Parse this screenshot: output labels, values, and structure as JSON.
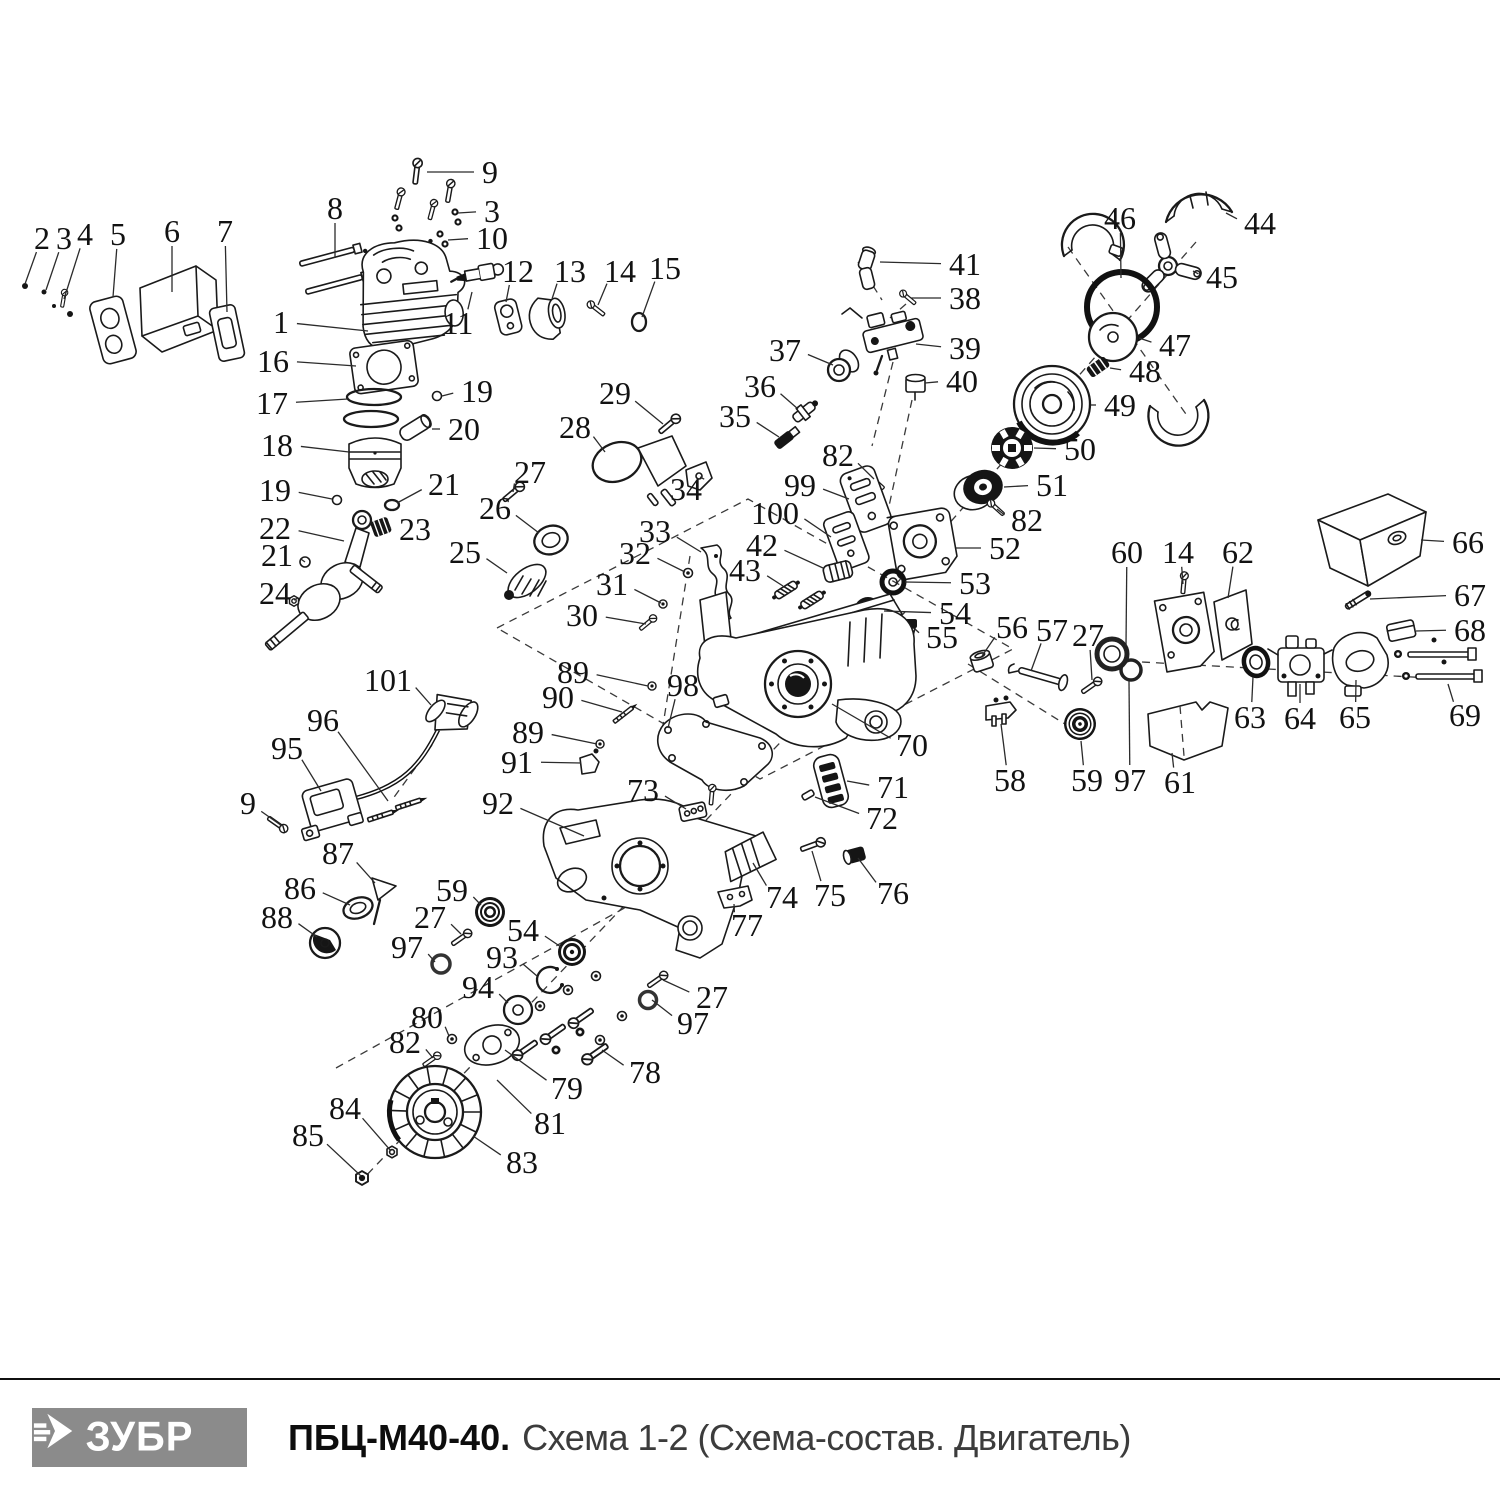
{
  "footer": {
    "logo_text": "ЗУБР",
    "logo_icon": "zubr-arrow-icon",
    "title_bold": "ПБЦ-М40-40.",
    "title_rest": "Схема 1-2 (Схема-состав. Двигатель)"
  },
  "diagram": {
    "labels": [
      {
        "t": "2",
        "x": 42,
        "y": 238,
        "tx": 25,
        "ty": 284
      },
      {
        "t": "3",
        "x": 64,
        "y": 238,
        "tx": 46,
        "ty": 290
      },
      {
        "t": "4",
        "x": 85,
        "y": 234,
        "tx": 64,
        "ty": 299
      },
      {
        "t": "5",
        "x": 118,
        "y": 234,
        "tx": 113,
        "ty": 297
      },
      {
        "t": "6",
        "x": 172,
        "y": 231,
        "tx": 172,
        "ty": 292
      },
      {
        "t": "7",
        "x": 225,
        "y": 231,
        "tx": 227,
        "ty": 312
      },
      {
        "t": "9",
        "x": 490,
        "y": 172,
        "tx": 427,
        "ty": 172
      },
      {
        "t": "8",
        "x": 335,
        "y": 208,
        "tx": 335,
        "ty": 258
      },
      {
        "t": "3",
        "x": 492,
        "y": 211,
        "tx": 458,
        "ty": 213
      },
      {
        "t": "10",
        "x": 492,
        "y": 238,
        "tx": 448,
        "ty": 240
      },
      {
        "t": "1",
        "x": 281,
        "y": 322,
        "tx": 368,
        "ty": 331
      },
      {
        "t": "11",
        "x": 458,
        "y": 323,
        "tx": 472,
        "ty": 292
      },
      {
        "t": "12",
        "x": 518,
        "y": 271,
        "tx": 506,
        "ty": 302
      },
      {
        "t": "13",
        "x": 570,
        "y": 271,
        "tx": 552,
        "ty": 299
      },
      {
        "t": "14",
        "x": 620,
        "y": 271,
        "tx": 598,
        "ty": 305
      },
      {
        "t": "15",
        "x": 665,
        "y": 268,
        "tx": 642,
        "ty": 317
      },
      {
        "t": "16",
        "x": 273,
        "y": 361,
        "tx": 356,
        "ty": 366
      },
      {
        "t": "17",
        "x": 272,
        "y": 403,
        "tx": 348,
        "ty": 399
      },
      {
        "t": "19",
        "x": 477,
        "y": 391,
        "tx": 442,
        "ty": 396
      },
      {
        "t": "20",
        "x": 464,
        "y": 429,
        "tx": 432,
        "ty": 429
      },
      {
        "t": "18",
        "x": 277,
        "y": 445,
        "tx": 349,
        "ty": 452
      },
      {
        "t": "19",
        "x": 275,
        "y": 490,
        "tx": 332,
        "ty": 499
      },
      {
        "t": "21",
        "x": 444,
        "y": 484,
        "tx": 397,
        "ty": 503
      },
      {
        "t": "22",
        "x": 275,
        "y": 528,
        "tx": 344,
        "ty": 541
      },
      {
        "t": "23",
        "x": 415,
        "y": 529,
        "tx": 389,
        "ty": 528
      },
      {
        "t": "21",
        "x": 277,
        "y": 555,
        "tx": 305,
        "ty": 562
      },
      {
        "t": "24",
        "x": 275,
        "y": 593,
        "tx": 294,
        "ty": 600
      },
      {
        "t": "25",
        "x": 465,
        "y": 552,
        "tx": 507,
        "ty": 573
      },
      {
        "t": "26",
        "x": 495,
        "y": 508,
        "tx": 539,
        "ty": 533
      },
      {
        "t": "27",
        "x": 530,
        "y": 472,
        "tx": 513,
        "ty": 492
      },
      {
        "t": "28",
        "x": 575,
        "y": 427,
        "tx": 605,
        "ty": 452
      },
      {
        "t": "29",
        "x": 615,
        "y": 393,
        "tx": 663,
        "ty": 424
      },
      {
        "t": "34",
        "x": 686,
        "y": 489,
        "tx": 700,
        "ty": 477
      },
      {
        "t": "33",
        "x": 655,
        "y": 531,
        "tx": 701,
        "ty": 552
      },
      {
        "t": "32",
        "x": 635,
        "y": 553,
        "tx": 685,
        "ty": 572
      },
      {
        "t": "31",
        "x": 612,
        "y": 584,
        "tx": 661,
        "ty": 603
      },
      {
        "t": "30",
        "x": 582,
        "y": 615,
        "tx": 646,
        "ty": 624
      },
      {
        "t": "35",
        "x": 735,
        "y": 416,
        "tx": 779,
        "ty": 437
      },
      {
        "t": "36",
        "x": 760,
        "y": 386,
        "tx": 798,
        "ty": 409
      },
      {
        "t": "37",
        "x": 785,
        "y": 350,
        "tx": 833,
        "ty": 365
      },
      {
        "t": "41",
        "x": 965,
        "y": 264,
        "tx": 880,
        "ty": 262
      },
      {
        "t": "38",
        "x": 965,
        "y": 298,
        "tx": 911,
        "ty": 298
      },
      {
        "t": "39",
        "x": 965,
        "y": 348,
        "tx": 916,
        "ty": 344
      },
      {
        "t": "40",
        "x": 962,
        "y": 381,
        "tx": 925,
        "ty": 383
      },
      {
        "t": "46",
        "x": 1120,
        "y": 218,
        "tx": 1121,
        "ty": 278
      },
      {
        "t": "44",
        "x": 1260,
        "y": 223,
        "tx": 1226,
        "ty": 213
      },
      {
        "t": "45",
        "x": 1222,
        "y": 277,
        "tx": 1193,
        "ty": 271
      },
      {
        "t": "47",
        "x": 1175,
        "y": 345,
        "tx": 1139,
        "ty": 338
      },
      {
        "t": "48",
        "x": 1145,
        "y": 371,
        "tx": 1110,
        "ty": 368
      },
      {
        "t": "49",
        "x": 1120,
        "y": 405,
        "tx": 1091,
        "ty": 405
      },
      {
        "t": "50",
        "x": 1080,
        "y": 449,
        "tx": 1034,
        "ty": 448
      },
      {
        "t": "51",
        "x": 1052,
        "y": 485,
        "tx": 1004,
        "ty": 487
      },
      {
        "t": "82",
        "x": 1027,
        "y": 520,
        "tx": 997,
        "ty": 509
      },
      {
        "t": "52",
        "x": 1005,
        "y": 548,
        "tx": 956,
        "ty": 548
      },
      {
        "t": "53",
        "x": 975,
        "y": 583,
        "tx": 905,
        "ty": 582
      },
      {
        "t": "54",
        "x": 955,
        "y": 613,
        "tx": 884,
        "ty": 611
      },
      {
        "t": "55",
        "x": 942,
        "y": 637,
        "tx": 915,
        "ty": 629
      },
      {
        "t": "82",
        "x": 838,
        "y": 455,
        "tx": 874,
        "ty": 479
      },
      {
        "t": "99",
        "x": 800,
        "y": 485,
        "tx": 849,
        "ty": 499
      },
      {
        "t": "100",
        "x": 775,
        "y": 513,
        "tx": 831,
        "ty": 537
      },
      {
        "t": "42",
        "x": 762,
        "y": 545,
        "tx": 823,
        "ty": 568
      },
      {
        "t": "43",
        "x": 745,
        "y": 570,
        "tx": 783,
        "ty": 586
      },
      {
        "t": "60",
        "x": 1127,
        "y": 552,
        "tx": 1126,
        "ty": 646
      },
      {
        "t": "14",
        "x": 1178,
        "y": 552,
        "tx": 1183,
        "ty": 584
      },
      {
        "t": "62",
        "x": 1238,
        "y": 552,
        "tx": 1228,
        "ty": 598
      },
      {
        "t": "66",
        "x": 1468,
        "y": 542,
        "tx": 1421,
        "ty": 540
      },
      {
        "t": "67",
        "x": 1470,
        "y": 595,
        "tx": 1370,
        "ty": 599
      },
      {
        "t": "68",
        "x": 1470,
        "y": 630,
        "tx": 1416,
        "ty": 631
      },
      {
        "t": "56",
        "x": 1012,
        "y": 627,
        "tx": 982,
        "ty": 656
      },
      {
        "t": "57",
        "x": 1052,
        "y": 630,
        "tx": 1031,
        "ty": 671
      },
      {
        "t": "27",
        "x": 1088,
        "y": 635,
        "tx": 1092,
        "ty": 680
      },
      {
        "t": "63",
        "x": 1250,
        "y": 717,
        "tx": 1253,
        "ty": 677
      },
      {
        "t": "64",
        "x": 1300,
        "y": 718,
        "tx": 1300,
        "ty": 684
      },
      {
        "t": "65",
        "x": 1355,
        "y": 717,
        "tx": 1356,
        "ty": 680
      },
      {
        "t": "69",
        "x": 1465,
        "y": 715,
        "tx": 1448,
        "ty": 684
      },
      {
        "t": "58",
        "x": 1010,
        "y": 780,
        "tx": 1001,
        "ty": 724
      },
      {
        "t": "59",
        "x": 1087,
        "y": 780,
        "tx": 1081,
        "ty": 741
      },
      {
        "t": "97",
        "x": 1130,
        "y": 780,
        "tx": 1129,
        "ty": 681
      },
      {
        "t": "61",
        "x": 1180,
        "y": 782,
        "tx": 1172,
        "ty": 753
      },
      {
        "t": "70",
        "x": 912,
        "y": 745,
        "tx": 832,
        "ty": 704
      },
      {
        "t": "71",
        "x": 893,
        "y": 787,
        "tx": 847,
        "ty": 781
      },
      {
        "t": "72",
        "x": 882,
        "y": 818,
        "tx": 815,
        "ty": 797
      },
      {
        "t": "73",
        "x": 643,
        "y": 790,
        "tx": 686,
        "ty": 809
      },
      {
        "t": "74",
        "x": 782,
        "y": 897,
        "tx": 753,
        "ty": 863
      },
      {
        "t": "75",
        "x": 830,
        "y": 895,
        "tx": 812,
        "ty": 851
      },
      {
        "t": "76",
        "x": 893,
        "y": 893,
        "tx": 858,
        "ty": 858
      },
      {
        "t": "77",
        "x": 747,
        "y": 925,
        "tx": 734,
        "ty": 904
      },
      {
        "t": "101",
        "x": 388,
        "y": 680,
        "tx": 431,
        "ty": 705
      },
      {
        "t": "96",
        "x": 323,
        "y": 720,
        "tx": 388,
        "ty": 801
      },
      {
        "t": "95",
        "x": 287,
        "y": 748,
        "tx": 321,
        "ty": 791
      },
      {
        "t": "9",
        "x": 248,
        "y": 803,
        "tx": 282,
        "ty": 826
      },
      {
        "t": "89",
        "x": 573,
        "y": 672,
        "tx": 648,
        "ty": 686
      },
      {
        "t": "90",
        "x": 558,
        "y": 697,
        "tx": 622,
        "ty": 712
      },
      {
        "t": "89",
        "x": 528,
        "y": 732,
        "tx": 597,
        "ty": 744
      },
      {
        "t": "91",
        "x": 517,
        "y": 762,
        "tx": 581,
        "ty": 763
      },
      {
        "t": "98",
        "x": 683,
        "y": 685,
        "tx": 668,
        "ty": 728
      },
      {
        "t": "92",
        "x": 498,
        "y": 803,
        "tx": 584,
        "ty": 836
      },
      {
        "t": "87",
        "x": 338,
        "y": 853,
        "tx": 375,
        "ty": 883
      },
      {
        "t": "86",
        "x": 300,
        "y": 888,
        "tx": 350,
        "ty": 905
      },
      {
        "t": "88",
        "x": 277,
        "y": 917,
        "tx": 317,
        "ty": 937
      },
      {
        "t": "59",
        "x": 452,
        "y": 890,
        "tx": 481,
        "ty": 905
      },
      {
        "t": "27",
        "x": 430,
        "y": 917,
        "tx": 461,
        "ty": 934
      },
      {
        "t": "97",
        "x": 407,
        "y": 947,
        "tx": 435,
        "ty": 962
      },
      {
        "t": "54",
        "x": 523,
        "y": 930,
        "tx": 561,
        "ty": 947
      },
      {
        "t": "93",
        "x": 502,
        "y": 957,
        "tx": 537,
        "ty": 976
      },
      {
        "t": "94",
        "x": 478,
        "y": 987,
        "tx": 508,
        "ty": 1003
      },
      {
        "t": "80",
        "x": 427,
        "y": 1017,
        "tx": 449,
        "ty": 1036
      },
      {
        "t": "82",
        "x": 405,
        "y": 1042,
        "tx": 433,
        "ty": 1058
      },
      {
        "t": "27",
        "x": 712,
        "y": 997,
        "tx": 663,
        "ty": 980
      },
      {
        "t": "97",
        "x": 693,
        "y": 1023,
        "tx": 652,
        "ty": 1000
      },
      {
        "t": "78",
        "x": 645,
        "y": 1072,
        "tx": 602,
        "ty": 1050
      },
      {
        "t": "79",
        "x": 567,
        "y": 1088,
        "tx": 505,
        "ty": 1050
      },
      {
        "t": "81",
        "x": 550,
        "y": 1123,
        "tx": 497,
        "ty": 1080
      },
      {
        "t": "83",
        "x": 522,
        "y": 1162,
        "tx": 473,
        "ty": 1136
      },
      {
        "t": "84",
        "x": 345,
        "y": 1108,
        "tx": 391,
        "ty": 1151
      },
      {
        "t": "85",
        "x": 308,
        "y": 1135,
        "tx": 361,
        "ty": 1176
      }
    ]
  }
}
